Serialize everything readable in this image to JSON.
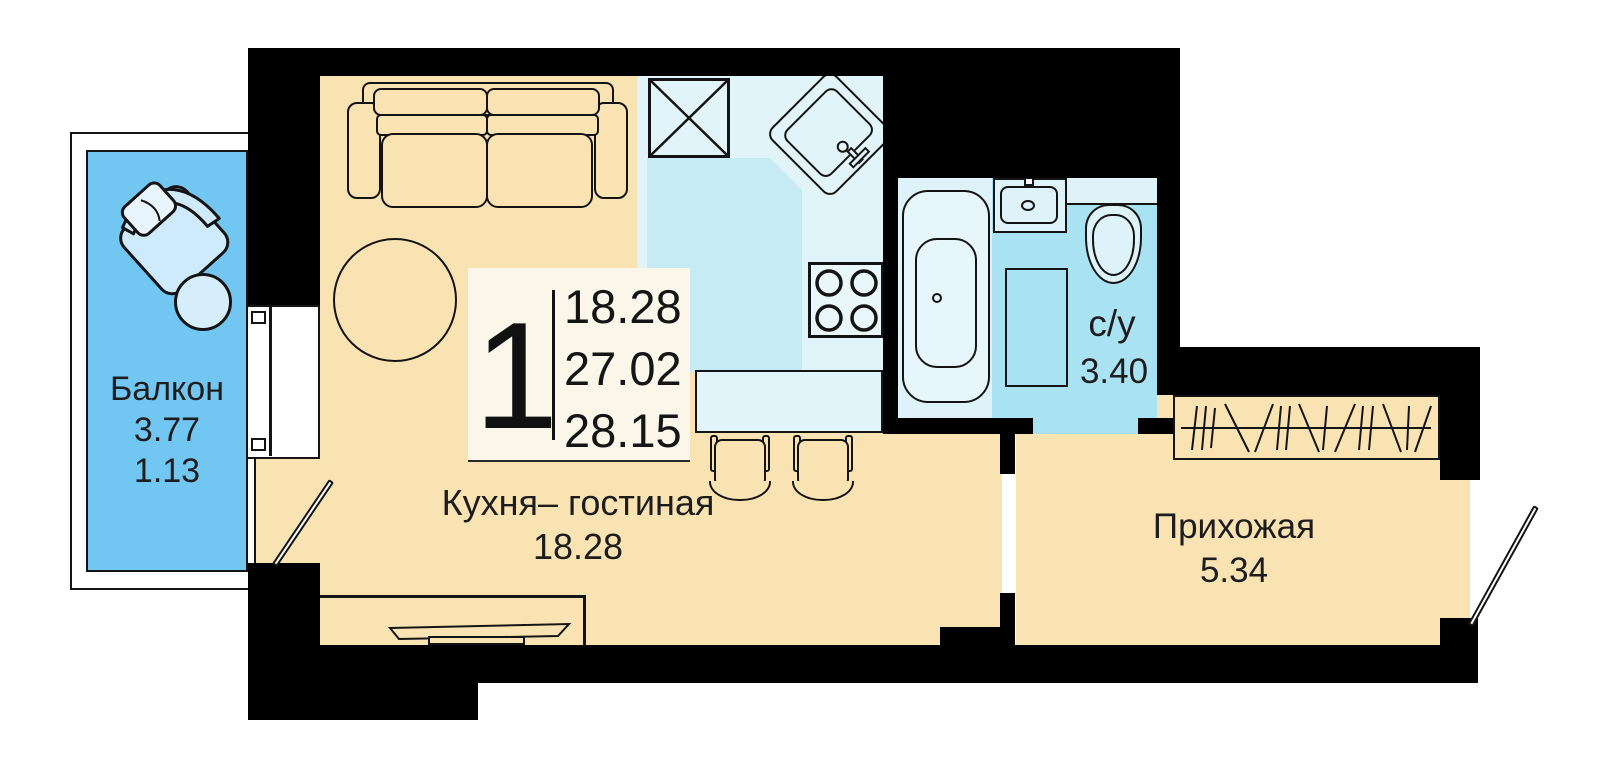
{
  "plan_title": "studio-apartment-floor-plan",
  "legend": {
    "count": "1",
    "values": [
      "18.28",
      "27.02",
      "28.15"
    ]
  },
  "rooms": {
    "kitchen_living": {
      "name": "Кухня– гостиная",
      "area": "18.28"
    },
    "hallway": {
      "name": "Прихожая",
      "area": "5.34"
    },
    "bathroom": {
      "name": "с/у",
      "area": "3.40"
    },
    "balcony": {
      "name": "Балкон",
      "area_full": "3.77",
      "area_reduced": "1.13"
    }
  },
  "palette": {
    "walls": "#000000",
    "room": "#fae3b2",
    "balcony": "#72c6f2",
    "kitchen_zone_light": "#e0f4f9",
    "kitchen_zone_dark": "#c7ebf5",
    "bathroom_light": "#ddf3f9",
    "bathroom_blue": "#a9e3f3",
    "legend_bg": "#fbf6ea",
    "furniture_blue": "#cfeafc",
    "furniture_blue_light": "#e8f5fe",
    "text": "#1d1d1d"
  }
}
